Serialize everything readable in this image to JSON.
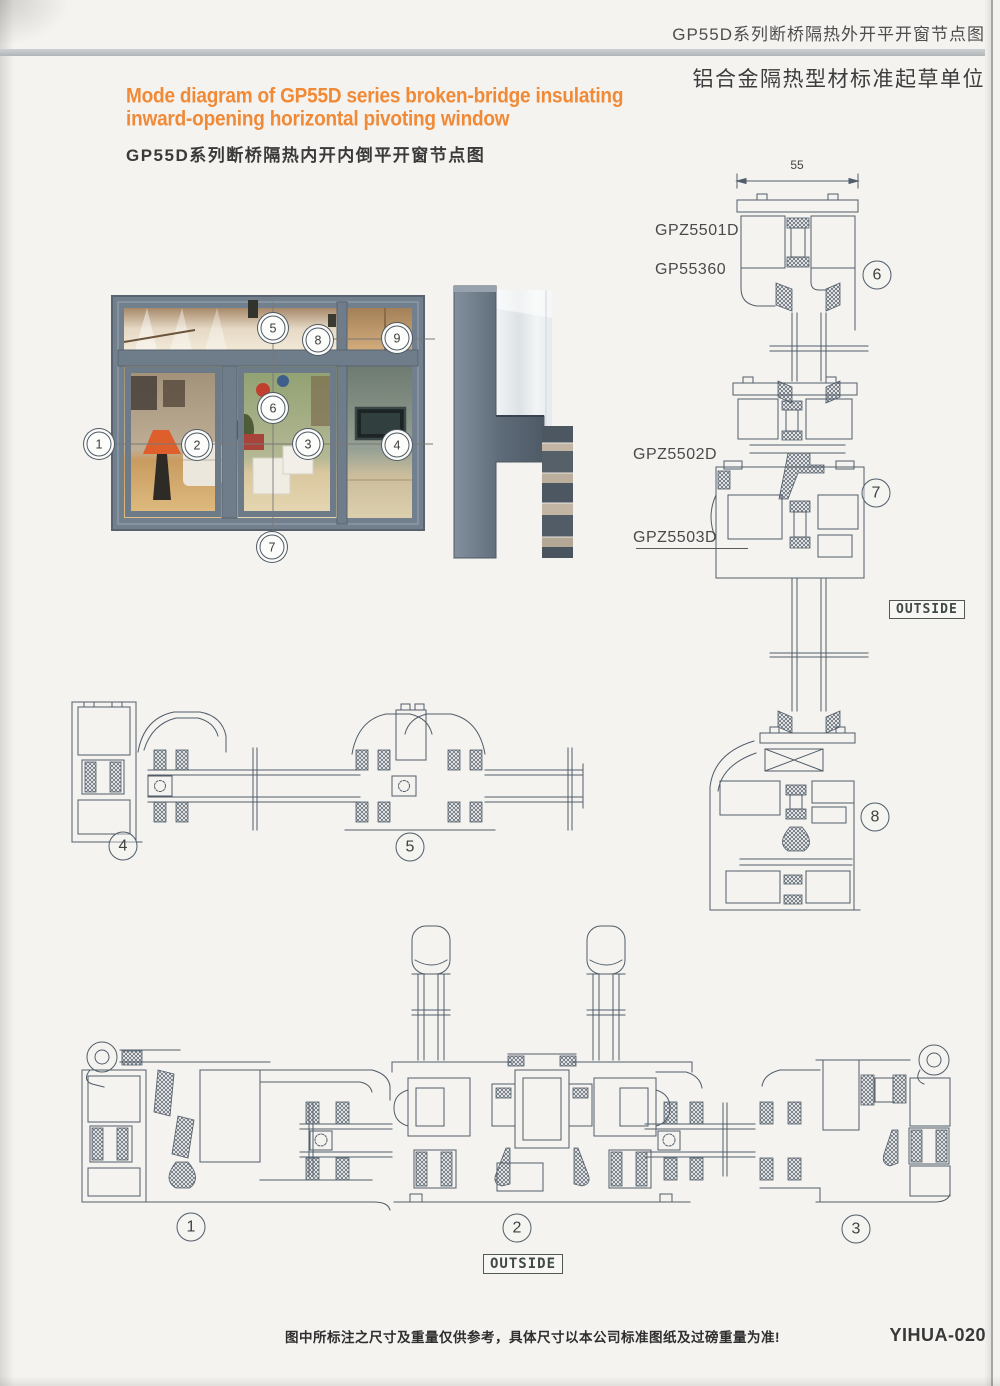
{
  "header": {
    "title": "GP55D系列断桥隔热外开平开窗节点图",
    "org": "铝合金隔热型材标准起草单位"
  },
  "main_title": {
    "en1": "Mode diagram of GP55D series broken-bridge insulating",
    "en2": "inward-opening horizontal pivoting window",
    "zh": "GP55D系列断桥隔热内开内倒平开窗节点图"
  },
  "drawing": {
    "dim": "55",
    "profiles": {
      "p5501": "GPZ5501D",
      "p55360": "GP55360",
      "p5502": "GPZ5502D",
      "p5503": "GPZ5503D"
    },
    "outside_right": "OUTSIDE",
    "outside_bottom": "OUTSIDE"
  },
  "callouts": {
    "photo": [
      "1",
      "2",
      "3",
      "4",
      "5",
      "6",
      "7",
      "8",
      "9"
    ],
    "mid": [
      "4",
      "5"
    ],
    "right": [
      "6",
      "7",
      "8"
    ],
    "bottom": [
      "1",
      "2",
      "3"
    ]
  },
  "footer": {
    "note": "图中所标注之尺寸及重量仅供参考，具体尺寸以本公司标准图纸及过磅重量为准!",
    "code": "YIHUA-020"
  }
}
